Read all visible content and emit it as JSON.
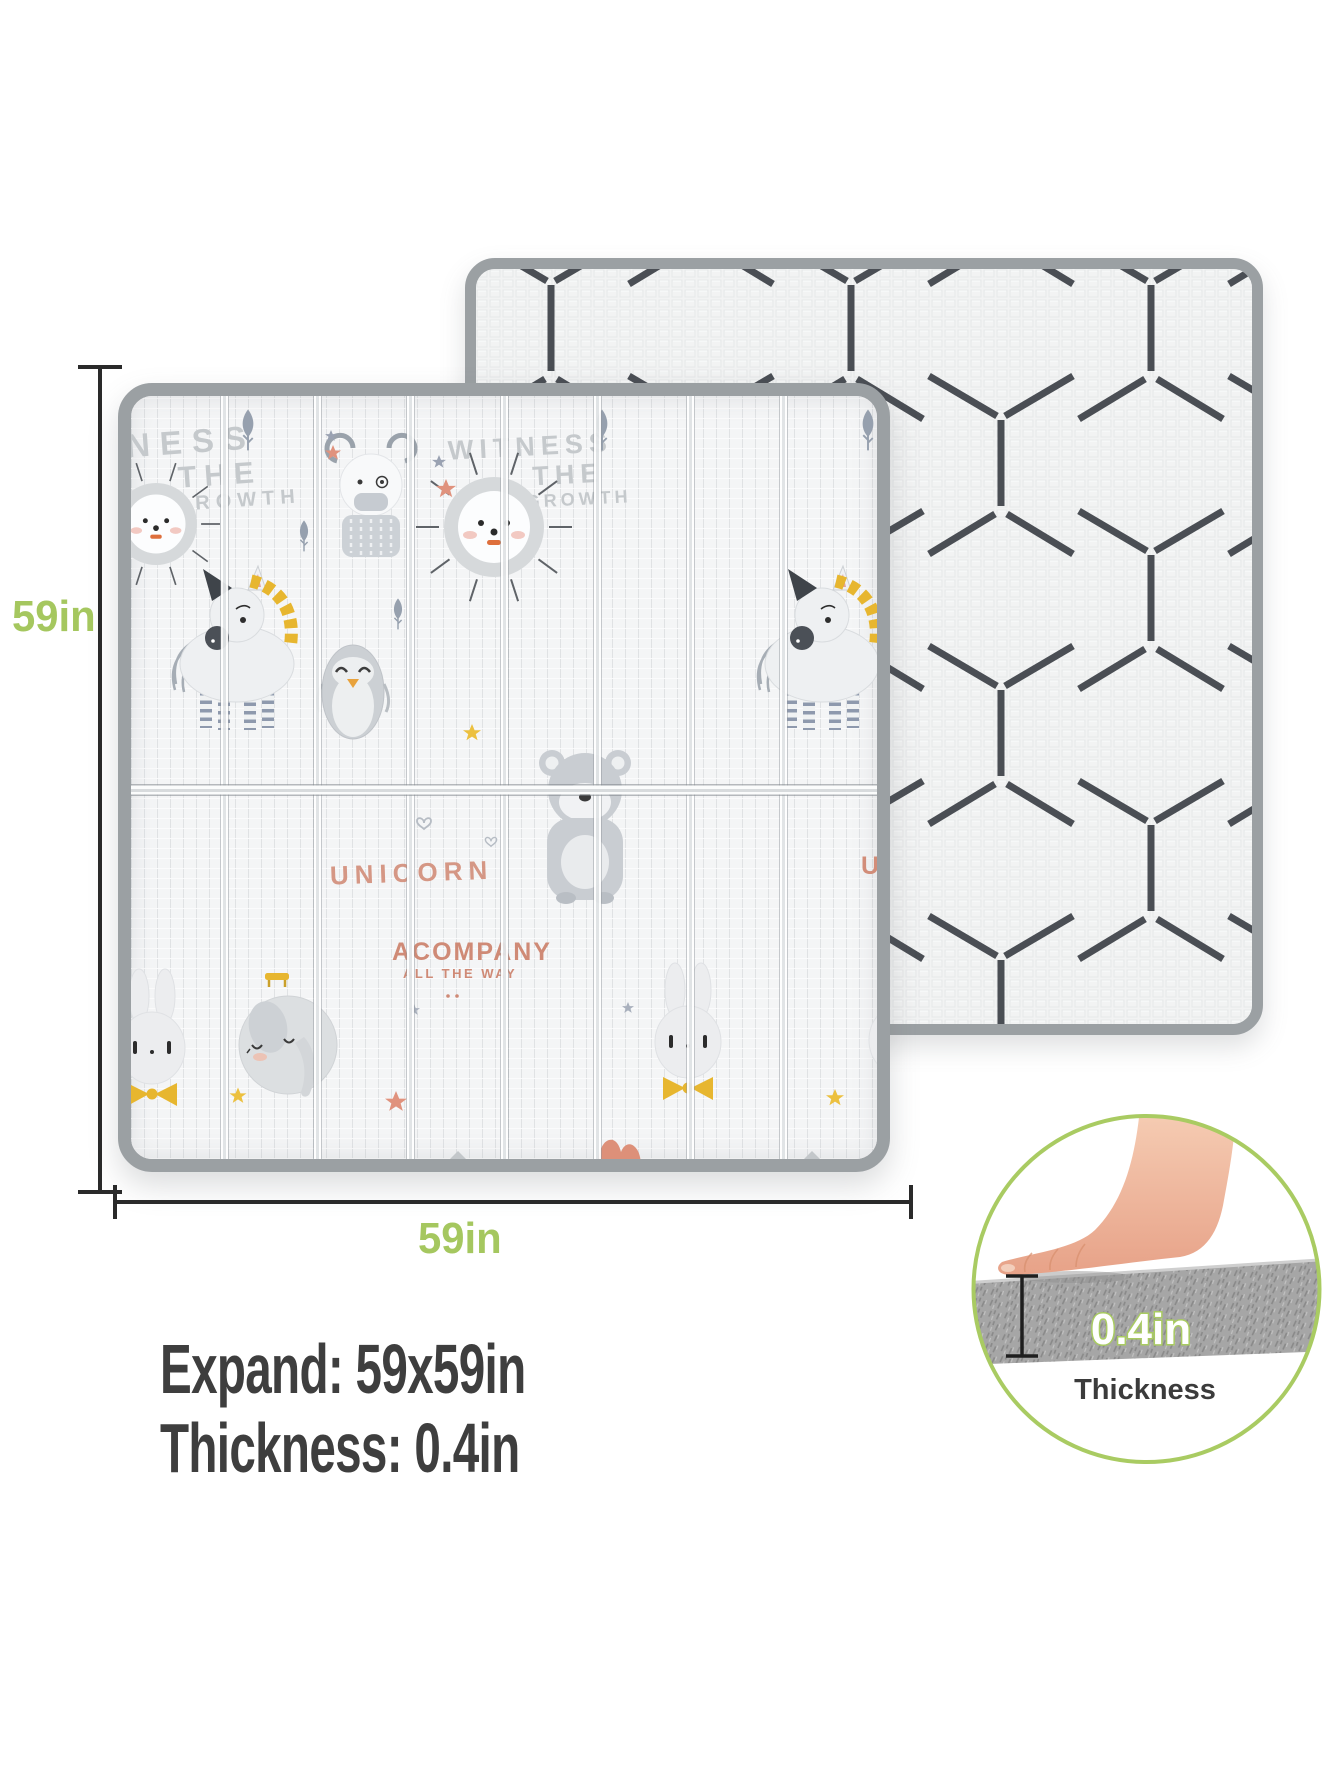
{
  "dim": {
    "height": "59in",
    "width": "59in"
  },
  "specs": {
    "expand": "Expand: 59x59in",
    "thickness": "Thickness: 0.4in"
  },
  "inset": {
    "value": "0.4in",
    "label": "Thickness"
  },
  "front_mat": {
    "slogan_left": {
      "l1": "WITNESS",
      "l2": "THE",
      "l3": "GROWTH"
    },
    "slogan_right": {
      "l1": "WITNESS",
      "l2": "THE",
      "l3": "GROWTH"
    },
    "word_unicorn": "UNICORN",
    "word_accompany": "ACOMPANY",
    "word_all_the_way": "ALL THE WAY",
    "word_partial_u": "U",
    "animal_icons": [
      "lion",
      "bear",
      "penguin",
      "unicorn",
      "koala-bear",
      "elephant",
      "rabbit"
    ],
    "decor_icons": [
      "tree-icon",
      "star-icon",
      "heart-icon",
      "moon-icon",
      "bench-icon",
      "cloud-icon"
    ]
  },
  "back_mat": {
    "pattern": "isometric-cube-lines"
  },
  "colors": {
    "accent_green": "#a5c75f",
    "text_dark": "#3e3e3e",
    "mat_border": "#9ba0a3",
    "pattern_line": "#3b4046",
    "salmon": "#d28d79",
    "gold": "#e7b62f",
    "animal_gray": "#d2d5d8"
  }
}
